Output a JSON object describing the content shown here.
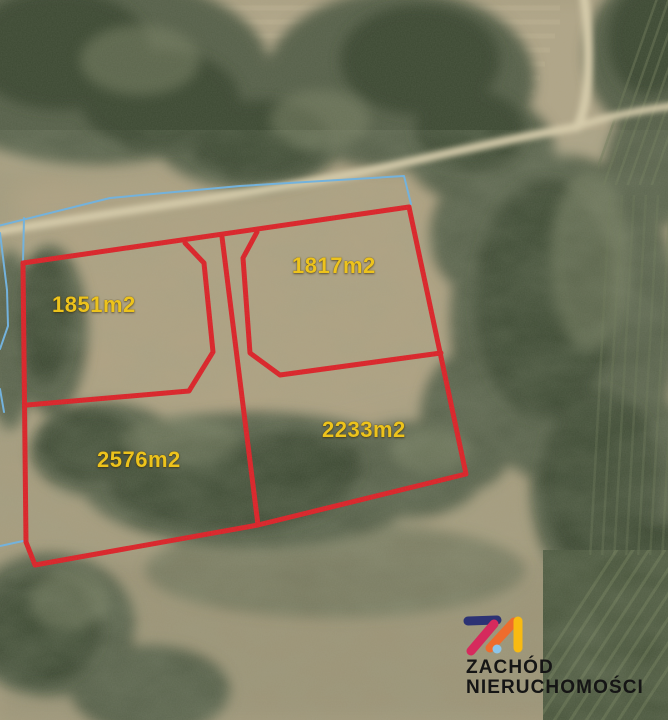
{
  "map": {
    "type": "aerial-photo-with-parcel-overlay",
    "parcels": [
      {
        "id": "top-left",
        "area_label": "1851m2"
      },
      {
        "id": "top-right",
        "area_label": "1817m2"
      },
      {
        "id": "bottom-left",
        "area_label": "2576m2"
      },
      {
        "id": "bottom-right",
        "area_label": "2233m2"
      }
    ]
  },
  "logo": {
    "mark_icon": "zn-monogram",
    "line1": "ZACHÓD",
    "line2": "NIERUCHOMOŚCI"
  },
  "colors": {
    "parcel_outline": "#dc2026",
    "cadastral_line": "#6fb2e0",
    "area_label": "#edc31c",
    "logo_text": "#151515",
    "logo_navy": "#2c3274",
    "logo_magenta": "#d62a5d",
    "logo_orange": "#ee6c2c",
    "logo_yellow": "#f8ba12",
    "logo_dot": "#8cc5e9"
  }
}
